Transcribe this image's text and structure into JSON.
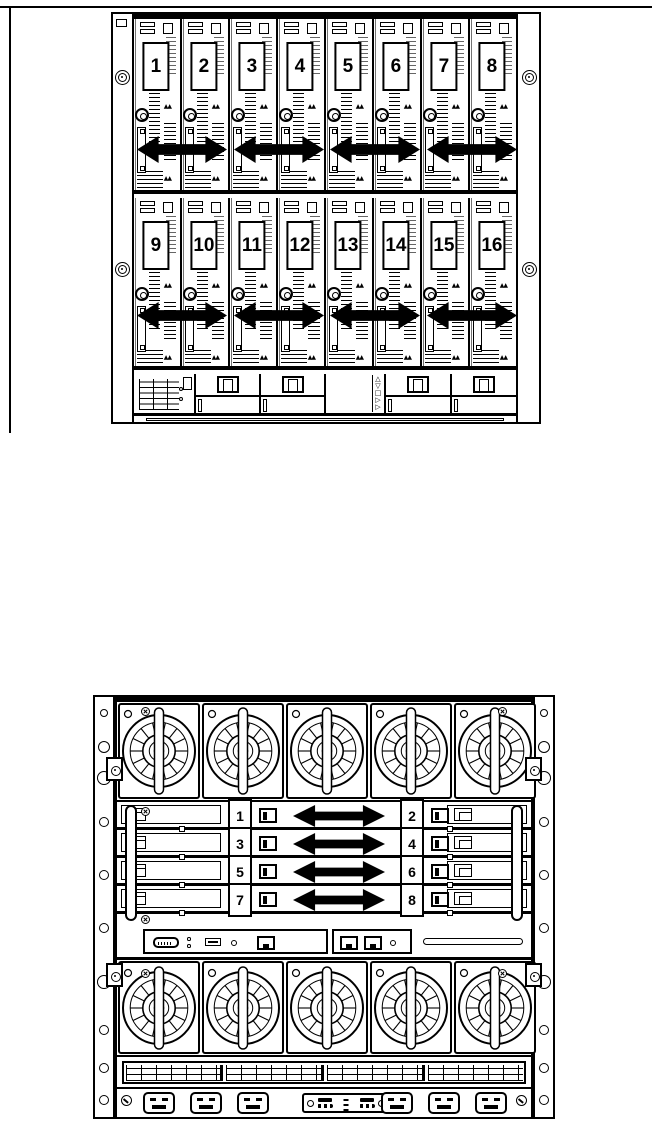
{
  "colors": {
    "ink": "#000000",
    "paper": "#ffffff"
  },
  "front_view": {
    "rows": [
      {
        "bays": [
          "1",
          "2",
          "3",
          "4",
          "5",
          "6",
          "7",
          "8"
        ]
      },
      {
        "bays": [
          "9",
          "10",
          "11",
          "12",
          "13",
          "14",
          "15",
          "16"
        ]
      }
    ],
    "arrow_pairs_per_row": 4,
    "lock_glyph": "▲▲",
    "insight_display": {
      "nav_up_down": "△\n▽",
      "nav_ok": "□",
      "nav_right": "▷\n▷"
    }
  },
  "rear_view": {
    "fans_top": 5,
    "fans_bottom": 5,
    "interconnect_rows": [
      {
        "left": "1",
        "right": "2"
      },
      {
        "left": "3",
        "right": "4"
      },
      {
        "left": "5",
        "right": "6"
      },
      {
        "left": "7",
        "right": "8"
      }
    ],
    "power_sockets_left": 3,
    "power_sockets_right": 3,
    "louver_groups": 4
  }
}
